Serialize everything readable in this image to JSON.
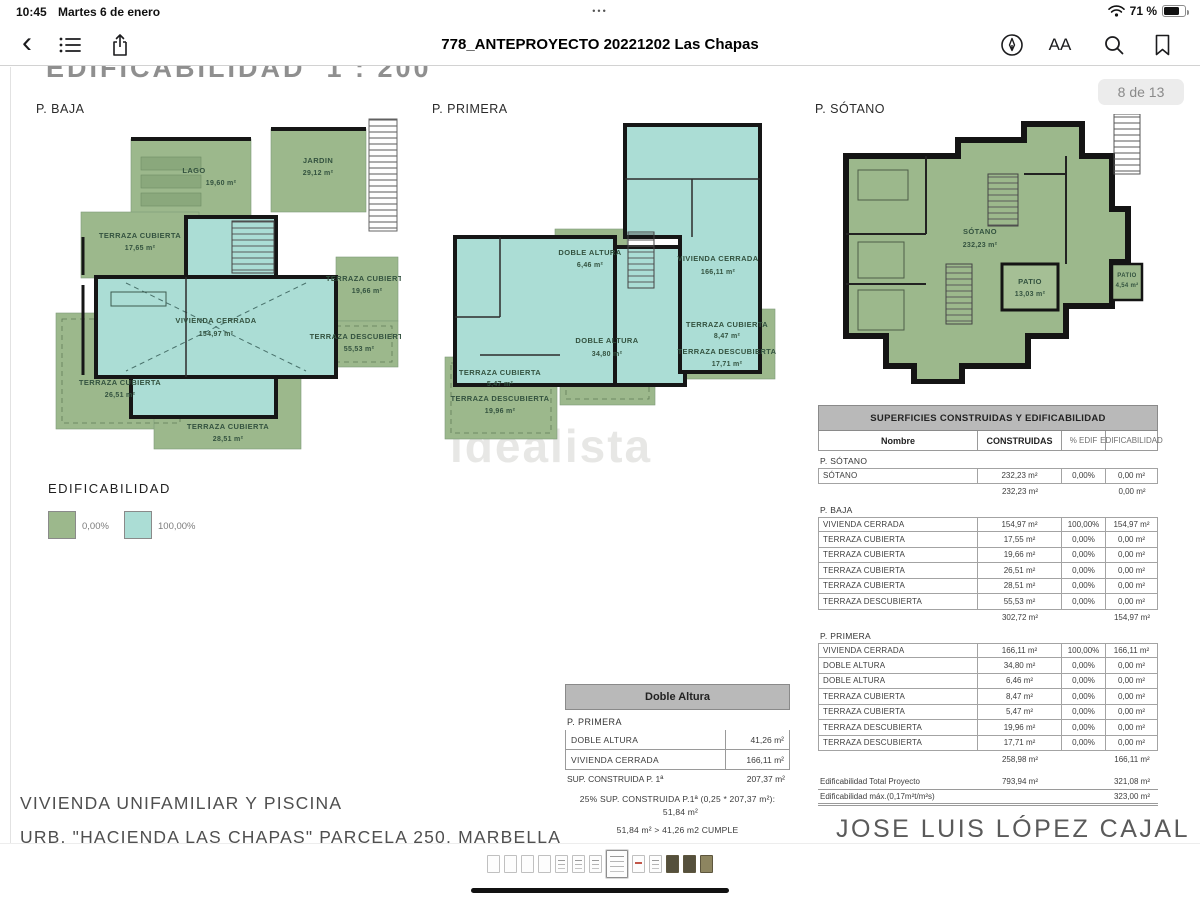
{
  "status_bar": {
    "time": "10:45",
    "date": "Martes 6 de enero",
    "multitask_dots": "•••",
    "battery_pct": "71 %"
  },
  "toolbar": {
    "title": "778_ANTEPROYECTO 20221202 Las Chapas",
    "text_size_label": "AA"
  },
  "page": {
    "heading": "EDIFICABILIDAD  1 : 200",
    "page_badge": "8 de 13",
    "watermark": "idealista",
    "project_title": "VIVIENDA UNIFAMILIAR Y PISCINA",
    "project_subtitle": "URB. \"HACIENDA LAS CHAPAS\" PARCELA 250, MARBELLA",
    "architect": "JOSE LUIS LÓPEZ CAJAL"
  },
  "plans": {
    "baja": {
      "label": "P. BAJA",
      "areas": [
        {
          "name": "JARDIN",
          "value": "29,12 m²"
        },
        {
          "name": "LAGO",
          "value": "19,60 m²"
        },
        {
          "name": "TERRAZA CUBIERTA",
          "value": "17,65 m²"
        },
        {
          "name": "VIVIENDA CERRADA",
          "value": "154,97 m²"
        },
        {
          "name": "TERRAZA CUBIERTA",
          "value": "19,66 m²"
        },
        {
          "name": "TERRAZA DESCUBIERTA",
          "value": "55,53 m²"
        },
        {
          "name": "TERRAZA CUBIERTA",
          "value": "26,51 m²"
        },
        {
          "name": "TERRAZA CUBIERTA",
          "value": "28,51 m²"
        }
      ]
    },
    "primera": {
      "label": "P. PRIMERA",
      "areas": [
        {
          "name": "DOBLE ALTURA",
          "value": "6,46 m²"
        },
        {
          "name": "VIVIENDA CERRADA",
          "value": "166,11 m²"
        },
        {
          "name": "DOBLE ALTURA",
          "value": "34,80 m²"
        },
        {
          "name": "TERRAZA CUBIERTA",
          "value": "5,47 m²"
        },
        {
          "name": "TERRAZA DESCUBIERTA",
          "value": "19,96 m²"
        },
        {
          "name": "TERRAZA CUBIERTA",
          "value": "8,47 m²"
        },
        {
          "name": "TERRAZA DESCUBIERTA",
          "value": "17,71 m²"
        }
      ]
    },
    "sotano": {
      "label": "P. SÓTANO",
      "areas": [
        {
          "name": "SÓTANO",
          "value": "232,23 m²"
        },
        {
          "name": "PATIO",
          "value": "13,03 m²"
        },
        {
          "name": "PATIO",
          "value": "4,54 m²"
        }
      ]
    }
  },
  "legend": {
    "title": "EDIFICABILIDAD",
    "items": [
      {
        "label": "0,00%",
        "color": "#9cb88c"
      },
      {
        "label": "100,00%",
        "color": "#abddd5"
      }
    ]
  },
  "doble_altura_table": {
    "title": "Doble Altura",
    "section": "P. PRIMERA",
    "rows": [
      {
        "name": "DOBLE ALTURA",
        "value": "41,26 m²"
      },
      {
        "name": "VIVIENDA CERRADA",
        "value": "166,11 m²"
      }
    ],
    "sum_label": "SUP. CONSTRUIDA P. 1ª",
    "sum_value": "207,37 m²",
    "note1": "25% SUP. CONSTRUIDA P.1ª (0,25 * 207,37 m²):",
    "note1_value": "51,84 m²",
    "note2": "51,84 m²  >  41,26 m2  CUMPLE"
  },
  "surfaces_table": {
    "title": "SUPERFICIES CONSTRUIDAS Y EDIFICABILIDAD",
    "columns": [
      "Nombre",
      "CONSTRUIDAS",
      "% EDIF",
      "EDIFICABILIDAD"
    ],
    "sections": [
      {
        "name": "P. SÓTANO",
        "rows": [
          [
            "SÓTANO",
            "232,23 m²",
            "0,00%",
            "0,00 m²"
          ]
        ],
        "subtotal": {
          "construidas": "232,23 m²",
          "edificabilidad": "0,00 m²"
        }
      },
      {
        "name": "P. BAJA",
        "rows": [
          [
            "VIVIENDA CERRADA",
            "154,97 m²",
            "100,00%",
            "154,97 m²"
          ],
          [
            "TERRAZA CUBIERTA",
            "17,55 m²",
            "0,00%",
            "0,00 m²"
          ],
          [
            "TERRAZA CUBIERTA",
            "19,66 m²",
            "0,00%",
            "0,00 m²"
          ],
          [
            "TERRAZA CUBIERTA",
            "26,51 m²",
            "0,00%",
            "0,00 m²"
          ],
          [
            "TERRAZA CUBIERTA",
            "28,51 m²",
            "0,00%",
            "0,00 m²"
          ],
          [
            "TERRAZA DESCUBIERTA",
            "55,53 m²",
            "0,00%",
            "0,00 m²"
          ]
        ],
        "subtotal": {
          "construidas": "302,72 m²",
          "edificabilidad": "154,97 m²"
        }
      },
      {
        "name": "P. PRIMERA",
        "rows": [
          [
            "VIVIENDA CERRADA",
            "166,11 m²",
            "100,00%",
            "166,11 m²"
          ],
          [
            "DOBLE ALTURA",
            "34,80 m²",
            "0,00%",
            "0,00 m²"
          ],
          [
            "DOBLE ALTURA",
            "6,46 m²",
            "0,00%",
            "0,00 m²"
          ],
          [
            "TERRAZA CUBIERTA",
            "8,47 m²",
            "0,00%",
            "0,00 m²"
          ],
          [
            "TERRAZA CUBIERTA",
            "5,47 m²",
            "0,00%",
            "0,00 m²"
          ],
          [
            "TERRAZA DESCUBIERTA",
            "19,96 m²",
            "0,00%",
            "0,00 m²"
          ],
          [
            "TERRAZA DESCUBIERTA",
            "17,71 m²",
            "0,00%",
            "0,00 m²"
          ]
        ],
        "subtotal": {
          "construidas": "258,98 m²",
          "edificabilidad": "166,11 m²"
        }
      }
    ],
    "totals": [
      {
        "label": "Edificabilidad Total Proyecto",
        "construidas": "793,94 m²",
        "edificabilidad": "321,08 m²"
      },
      {
        "label": "Edificabilidad máx.(0,17m²t/m²s)",
        "construidas": "",
        "edificabilidad": "323,00 m²"
      }
    ]
  },
  "thumbnails": {
    "current_index": 7,
    "items": [
      "blank",
      "blank",
      "blank",
      "blank",
      "sketch",
      "sketch",
      "sketch",
      "current",
      "red",
      "sketch",
      "photo-dark",
      "photo-dark",
      "photo-olive"
    ]
  }
}
